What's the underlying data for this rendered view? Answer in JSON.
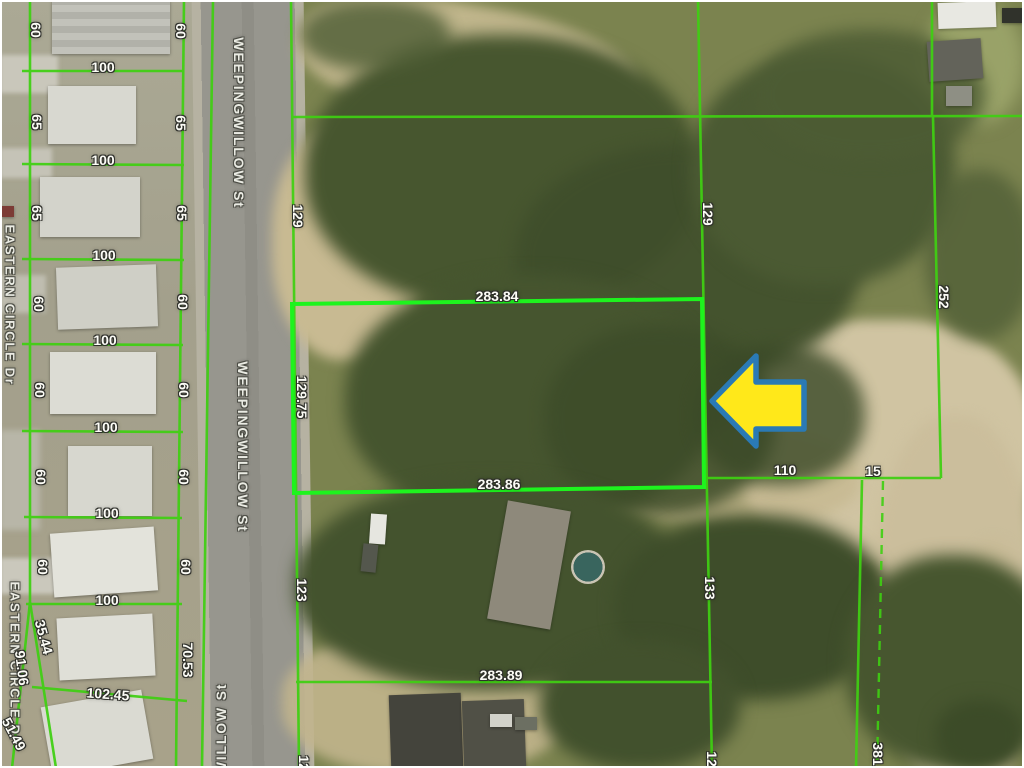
{
  "title": "Aerial parcel map with lot dimensions",
  "streets": {
    "ww1": "WEEPINGWILLOW St",
    "ww2": "WEEPINGWILLOW St",
    "ww3": "WILLOW St",
    "ec1": "EASTERN CIRCLE Dr",
    "ec2": "EASTERN CIRCLE Dr"
  },
  "subject": {
    "top": "283.84",
    "side": "129.75",
    "bottom": "283.86"
  },
  "dims": {
    "rowsL": [
      "60",
      "65",
      "65",
      "60",
      "60",
      "60",
      "60"
    ],
    "rowsR": [
      "60",
      "65",
      "65",
      "60",
      "60",
      "60",
      "60"
    ],
    "widths": [
      "100",
      "100",
      "100",
      "100",
      "100",
      "100",
      "100"
    ],
    "extras": {
      "e3544": "35.44",
      "e9106": "91.06",
      "e5149": "51.49",
      "e10245": "102.45",
      "e7053": "70.53"
    },
    "center": {
      "l129": "129",
      "r129": "129",
      "l123": "123",
      "r133": "133",
      "b28389": "283.89",
      "cutL": "12",
      "cutR": "12"
    },
    "right": {
      "v252": "252",
      "h110": "110",
      "h15": "15",
      "v381": "381"
    }
  },
  "colors": {
    "parcel_line": "#3fd012",
    "subject_line": "#1ef31e",
    "arrow_fill": "#ffe81a",
    "arrow_outline": "#2a7ab5",
    "label_text": "#ffffff"
  }
}
